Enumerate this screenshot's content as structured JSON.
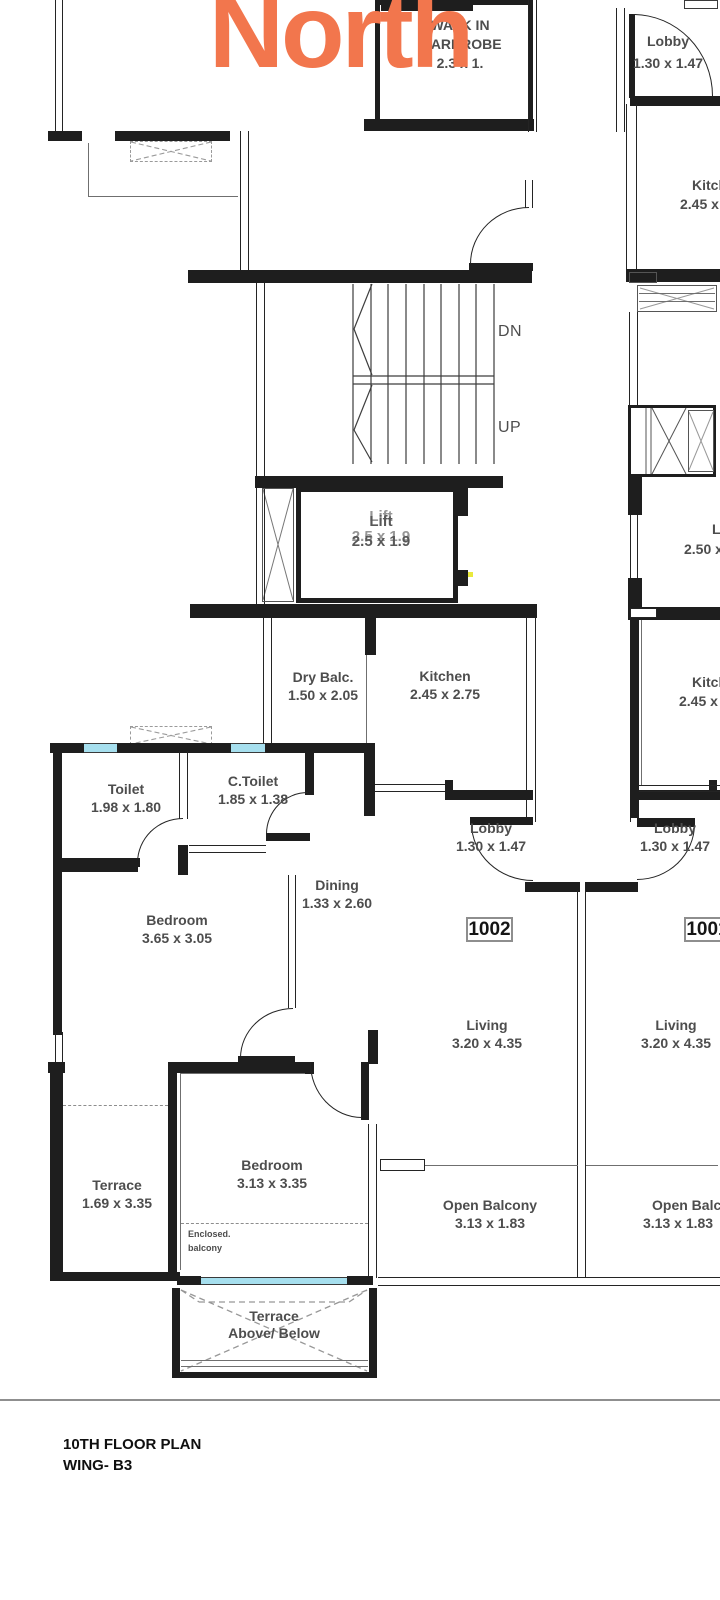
{
  "north": "North",
  "plan_title": {
    "line1": "10TH FLOOR PLAN",
    "line2": "WING- B3"
  },
  "stairs": {
    "down": "DN",
    "up": "UP"
  },
  "units": {
    "left": "1002",
    "right": "1001"
  },
  "rooms": {
    "walk_in_wardrobe": {
      "name1": "WALK IN",
      "name2": "WARDROBE",
      "dims": "2.3 x 1."
    },
    "lobby_top": {
      "name": "Lobby",
      "dims": "1.30 x 1.47"
    },
    "kitchen_top_right": {
      "name": "Kitchen",
      "dims": "2.45 x 2.75"
    },
    "lift": {
      "name": "Lift",
      "dims": "2.5 x 1.9"
    },
    "lobby_mid_right": {
      "name": "Lobby",
      "dims": "2.50 x"
    },
    "dry_balcony": {
      "name": "Dry Balc.",
      "dims": "1.50 x 2.05"
    },
    "kitchen_1002": {
      "name": "Kitchen",
      "dims": "2.45 x 2.75"
    },
    "kitchen_1001": {
      "name": "Kitchen",
      "dims": "2.45 x 2.75"
    },
    "toilet": {
      "name": "Toilet",
      "dims": "1.98 x 1.80"
    },
    "c_toilet": {
      "name": "C.Toilet",
      "dims": "1.85 x 1.38"
    },
    "dining": {
      "name": "Dining",
      "dims": "1.33 x 2.60"
    },
    "bedroom_main": {
      "name": "Bedroom",
      "dims": "3.65 x 3.05"
    },
    "lobby_1002": {
      "name": "Lobby",
      "dims": "1.30 x 1.47"
    },
    "lobby_1001": {
      "name": "Lobby",
      "dims": "1.30 x 1.47"
    },
    "living_1002": {
      "name": "Living",
      "dims": "3.20 x 4.35"
    },
    "living_1001": {
      "name": "Living",
      "dims": "3.20 x 4.35"
    },
    "terrace_side": {
      "name": "Terrace",
      "dims": "1.69 x 3.35"
    },
    "bedroom_second": {
      "name": "Bedroom",
      "dims": "3.13 x 3.35"
    },
    "enclosed_balcony": {
      "line1": "Enclosed.",
      "line2": "balcony"
    },
    "open_balcony_1002": {
      "name": "Open Balcony",
      "dims": "3.13 x 1.83"
    },
    "open_balcony_1001": {
      "name": "Open Balcony",
      "dims": "3.13 x 1.83"
    },
    "terrace_bottom": {
      "line1": "Terrace",
      "line2": "Above/ Below"
    }
  },
  "colors": {
    "north_orange": "#f2764d",
    "window_cyan": "#a6dfee",
    "wall_black": "#1e1e1e",
    "label_gray": "#4d4d4d"
  }
}
